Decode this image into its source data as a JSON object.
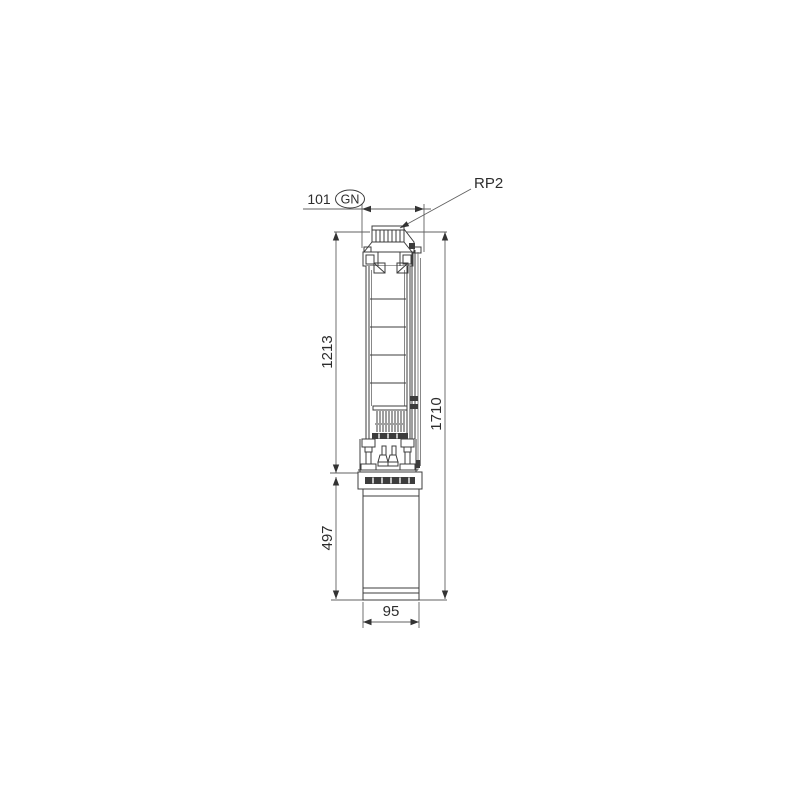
{
  "page": {
    "background": "#ffffff"
  },
  "drawing": {
    "line_color": "#3c3c3c",
    "dim_line_color": "#606060",
    "text_color": "#2d2d2d",
    "labels": {
      "thread_connection": "RP2",
      "gn_mark": "GN",
      "top_width": "101",
      "pump_length": "1213",
      "motor_length": "497",
      "overall_length": "1710",
      "motor_diameter": "95"
    }
  }
}
